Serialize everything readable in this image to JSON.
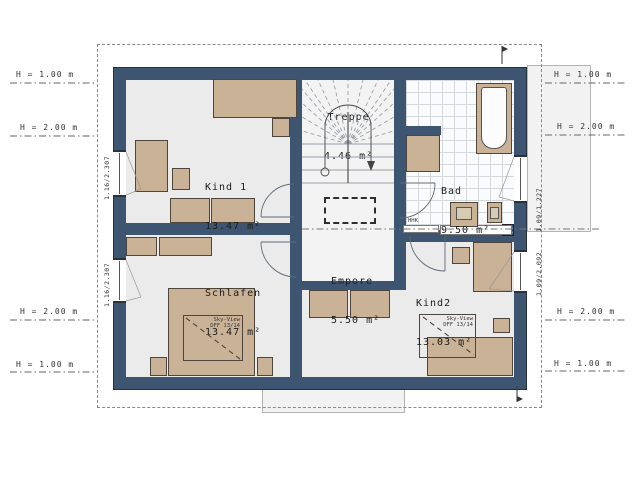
{
  "colors": {
    "wall": "#3D5570",
    "furniture": "#C9B295",
    "floor": "#EBEBEB",
    "tile_floor": "#FAFBFC",
    "roof_outline_dash": "#8A8A8A"
  },
  "rooms": [
    {
      "name": "Kind 1",
      "area": "13.47 m²"
    },
    {
      "name": "Treppe",
      "area": "4.46 m²"
    },
    {
      "name": "Bad",
      "area": "9.50 m²"
    },
    {
      "name": "Schlafen",
      "area": "13.47 m²"
    },
    {
      "name": "Empore",
      "area": "5.50 m²"
    },
    {
      "name": "Kind2",
      "area": "13.03 m²"
    }
  ],
  "window_labels": {
    "left_top": "1.16/2.307",
    "left_bottom": "1.16/2.307",
    "right_top": "1.09/1.227",
    "right_bottom": "1.09/2.092"
  },
  "height_marks": {
    "left": [
      "H = 1.00 m",
      "H = 2.00 m",
      "H = 2.00 m",
      "H = 1.00 m"
    ],
    "right": [
      "H = 1.00 m",
      "H = 2.00 m",
      "H = 2.00 m",
      "H = 1.00 m"
    ]
  },
  "annotations": {
    "radiator": "HHK",
    "skyview_line1": "Sky-View",
    "skyview_line2": "DFF 13/14"
  }
}
